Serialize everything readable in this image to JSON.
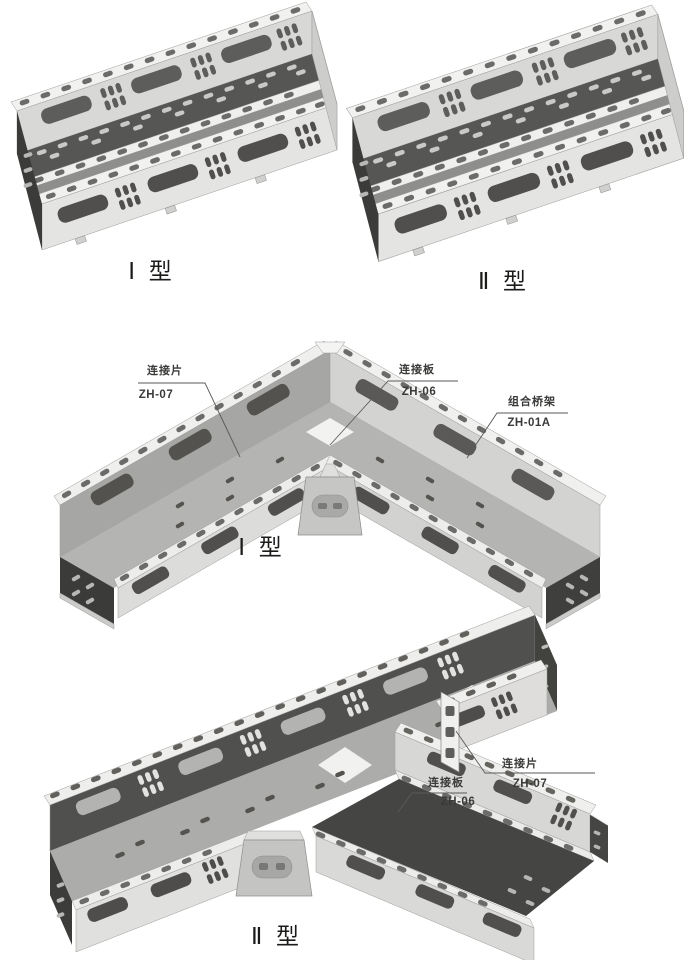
{
  "page": {
    "background": "#ffffff",
    "description": "组合桥架 cable tray catalog drawing"
  },
  "colors": {
    "metal_lightest": "#f1f1ef",
    "metal_light": "#e4e4e2",
    "metal_mid": "#d8d8d6",
    "metal_shadow": "#b4b4b2",
    "interior_dark": "#3b3b39",
    "hole_dark": "#504f4d",
    "hole_light": "#c9c9c7",
    "leader_line": "#5a5a58",
    "text": "#3a3a38"
  },
  "figures": [
    {
      "id": "straight-type1",
      "type_label": "Ⅰ 型"
    },
    {
      "id": "straight-type2",
      "type_label": "Ⅱ 型"
    },
    {
      "id": "corner-type1",
      "type_label": "Ⅰ 型",
      "callouts": [
        {
          "name": "连接片",
          "code": "ZH-07"
        },
        {
          "name": "连接板",
          "code": "ZH-06"
        },
        {
          "name": "组合桥架",
          "code": "ZH-01A"
        }
      ]
    },
    {
      "id": "tee-type2",
      "type_label": "Ⅱ 型",
      "callouts": [
        {
          "name": "连接片",
          "code": "ZH-07"
        },
        {
          "name": "连接板",
          "code": "ZH-06"
        }
      ]
    }
  ]
}
